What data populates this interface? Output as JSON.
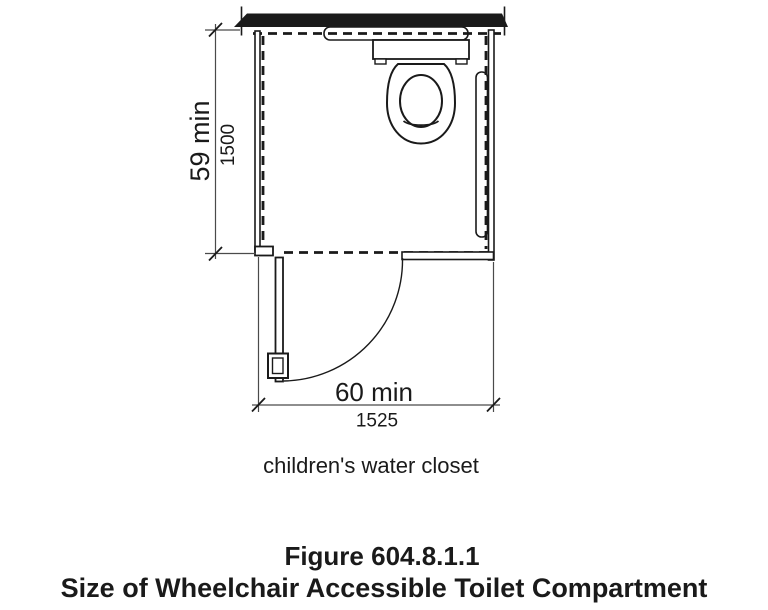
{
  "figure": {
    "number": "Figure 604.8.1.1",
    "title": "Size of Wheelchair Accessible Toilet Compartment",
    "caption": "children's water closet"
  },
  "dimensions": {
    "depth": {
      "label": "59 min",
      "metric": "1500"
    },
    "width": {
      "label": "60 min",
      "metric": "1525"
    }
  },
  "colors": {
    "ink": "#1a1a1a",
    "dimension_line": "#4a4a4a",
    "background": "#ffffff"
  }
}
